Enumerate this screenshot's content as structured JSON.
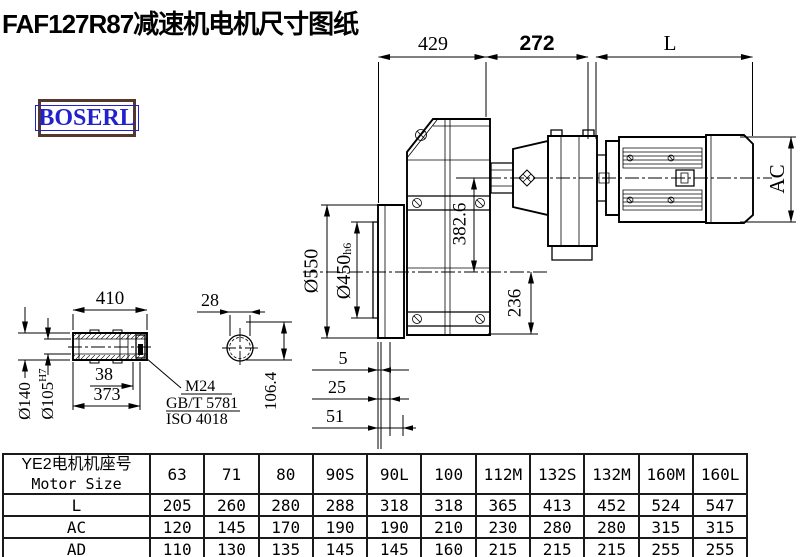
{
  "title": "FAF127R87减速机电机尺寸图纸",
  "logo": {
    "text": "BOSERL"
  },
  "colors": {
    "logo_text": "#2222cc",
    "logo_border": "#54382e",
    "line": "#000000"
  },
  "dimensions": {
    "top_429": "429",
    "top_272": "272",
    "top_L": "L",
    "ac": "AC",
    "dia_550": "Ø550",
    "dia_450": "Ø450",
    "dia_450_tol": "h6",
    "v_382_6": "382.6",
    "v_236": "236",
    "shaft_410": "410",
    "shaft_38": "38",
    "shaft_373": "373",
    "dia_140": "Ø140",
    "dia_105": "Ø105",
    "dia_105_tol": "H7",
    "key_28": "28",
    "key_106_4": "106.4",
    "bolt_m24": "M24",
    "bolt_std1": "GB/T 5781",
    "bolt_std2": "ISO 4018",
    "off_5": "5",
    "off_25": "25",
    "off_51": "51"
  },
  "table": {
    "header_cn": "YE2电机机座号",
    "header_en": "Motor Size",
    "columns": [
      "63",
      "71",
      "80",
      "90S",
      "90L",
      "100",
      "112M",
      "132S",
      "132M",
      "160M",
      "160L"
    ],
    "rows": [
      {
        "label": "L",
        "values": [
          "205",
          "260",
          "280",
          "288",
          "318",
          "318",
          "365",
          "413",
          "452",
          "524",
          "547"
        ]
      },
      {
        "label": "AC",
        "values": [
          "120",
          "145",
          "170",
          "190",
          "190",
          "210",
          "230",
          "280",
          "280",
          "315",
          "315"
        ]
      },
      {
        "label": "AD",
        "values": [
          "110",
          "130",
          "135",
          "145",
          "145",
          "160",
          "215",
          "215",
          "215",
          "255",
          "255"
        ]
      }
    ]
  }
}
